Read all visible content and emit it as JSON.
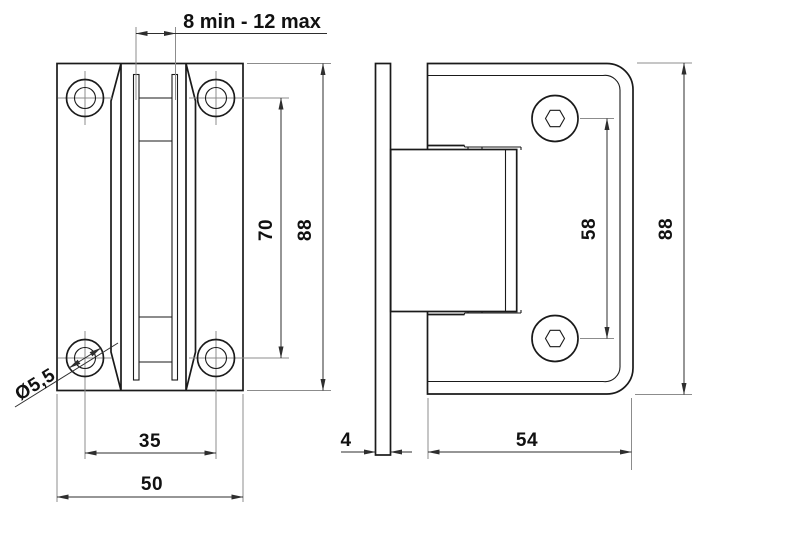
{
  "colors": {
    "outline": "#1a1a1a",
    "dimline": "#2e2e2e",
    "extline": "#8c8c8c",
    "text": "#111111",
    "background": "#ffffff"
  },
  "labels": {
    "glass_range": "8 min - 12 max",
    "hole_pitch_vertical": "70",
    "front_height": "88",
    "hole_pitch_horizontal": "35",
    "front_width": "50",
    "hole_diameter": "Ø5,5",
    "glass_thickness": "4",
    "side_width": "54",
    "screw_pitch": "58",
    "side_height": "88"
  }
}
